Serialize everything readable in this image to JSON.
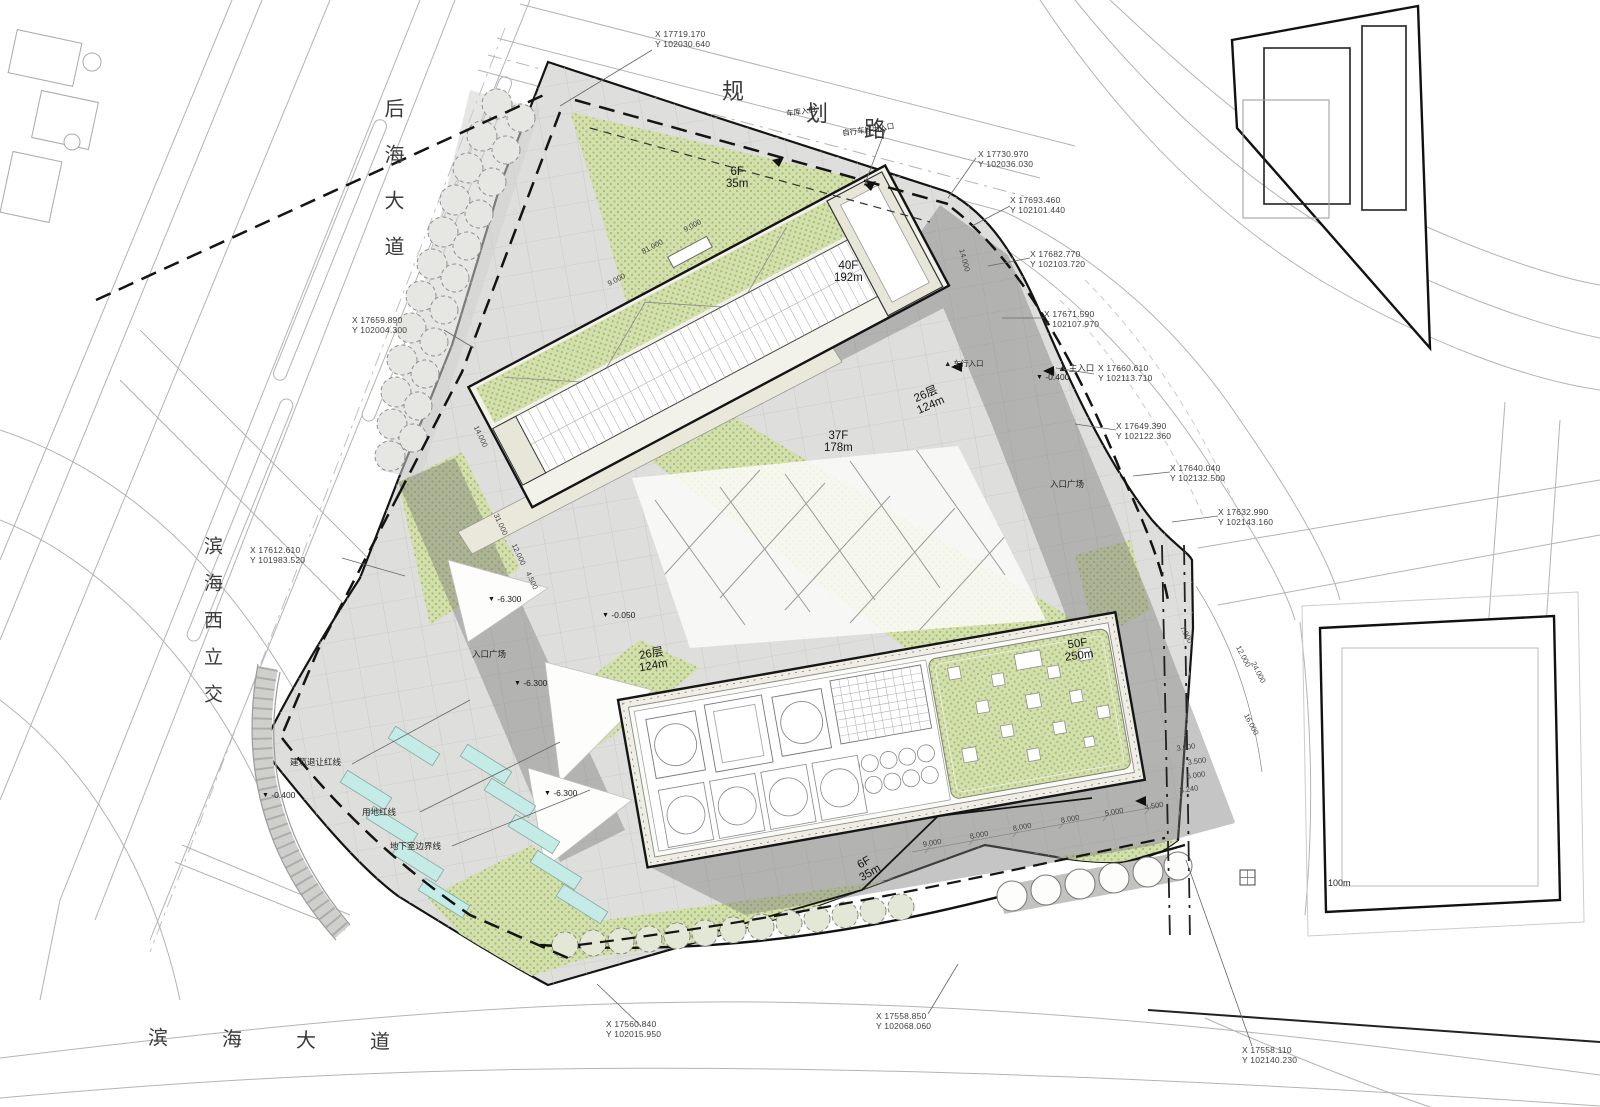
{
  "drawing": {
    "roads": {
      "top_chars": [
        "规",
        "划",
        "路"
      ],
      "left_top": "后海大道",
      "left_mid": "滨海西立交",
      "bottom": "滨海大道"
    },
    "buildings": [
      {
        "floors": "6F",
        "height": "35m"
      },
      {
        "floors": "40F",
        "height": "192m"
      },
      {
        "floors": "37F",
        "height": "178m"
      },
      {
        "floors": "26层",
        "height": "124m"
      },
      {
        "floors": "26层",
        "height": "124m"
      },
      {
        "floors": "50F",
        "height": "250m"
      },
      {
        "floors": "6F",
        "height": "35m"
      }
    ],
    "levels": [
      {
        "marker": "▼",
        "value": "-6.300"
      },
      {
        "marker": "▼",
        "value": "-0.050"
      },
      {
        "marker": "▼",
        "value": "-6.300"
      },
      {
        "marker": "▼",
        "value": "-6.300"
      },
      {
        "marker": "▼",
        "value": "-0.400"
      },
      {
        "marker": "▼",
        "value": "-0.400"
      }
    ],
    "coordinates": [
      {
        "x": "X 17719.170",
        "y": "Y 102030.640"
      },
      {
        "x": "X 17730.970",
        "y": "Y 102036.030"
      },
      {
        "x": "X 17693.460",
        "y": "Y 102101.440"
      },
      {
        "x": "X 17682.770",
        "y": "Y 102103.720"
      },
      {
        "x": "X 17671.590",
        "y": "Y 102107.970"
      },
      {
        "x": "X 17660.610",
        "y": "Y 102113.710"
      },
      {
        "x": "X 17649.390",
        "y": "Y 102122.360"
      },
      {
        "x": "X 17640.040",
        "y": "Y 102132.500"
      },
      {
        "x": "X 17632.990",
        "y": "Y 102143.160"
      },
      {
        "x": "X 17659.890",
        "y": "Y 102004.300"
      },
      {
        "x": "X 17612.610",
        "y": "Y 101983.520"
      },
      {
        "x": "X 17560.840",
        "y": "Y 102015.950"
      },
      {
        "x": "X 17558.850",
        "y": "Y 102068.060"
      },
      {
        "x": "X 17558.110",
        "y": "Y 102140.230"
      }
    ],
    "annotations": [
      {
        "text": "车库入口"
      },
      {
        "text": "自行车库出入口"
      },
      {
        "text": "▲ 主入口"
      },
      {
        "text": "入口广场"
      },
      {
        "text": "入口广场"
      },
      {
        "text": "建筑退让红线"
      },
      {
        "text": "用地红线"
      },
      {
        "text": "地下室边界线"
      },
      {
        "text": "▲ 车行入口"
      },
      {
        "text": "100m"
      }
    ],
    "dimensions": [
      "81.000",
      "9.000",
      "9.000",
      "14.000",
      "31.000",
      "12.000",
      "4.500",
      "7.000",
      "12.000",
      "24.000",
      "16.000",
      "3.000",
      "3.500",
      "6.000",
      "3.240",
      "9.000",
      "8.000",
      "8.000",
      "8.000",
      "5.000",
      "4.500",
      "14.000"
    ]
  },
  "palette": {
    "green_landscape": "#d3e0ab",
    "green_dot": "#a4bb79",
    "plaza_gray": "#dededc",
    "shadow_gray": "#777777",
    "skylight_cyan": "#c4ebe6",
    "boundary_black": "#141414",
    "road_gray": "#b3b3b0"
  }
}
